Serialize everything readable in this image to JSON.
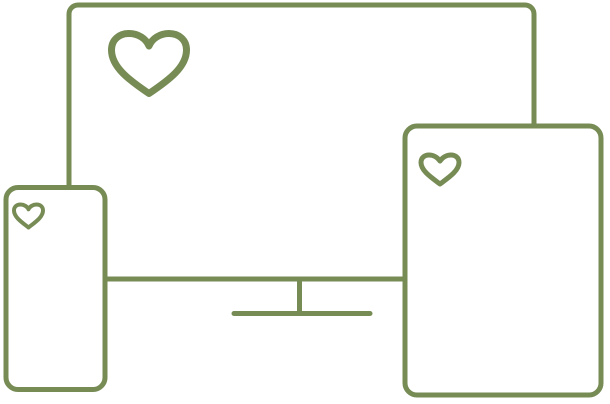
{
  "illustration": {
    "background_color": "#ffffff",
    "stroke_color": "#778b55",
    "devices": [
      {
        "icon": "monitor-with-heart-icon"
      },
      {
        "icon": "phone-with-heart-icon"
      },
      {
        "icon": "tablet-with-heart-icon"
      }
    ]
  }
}
